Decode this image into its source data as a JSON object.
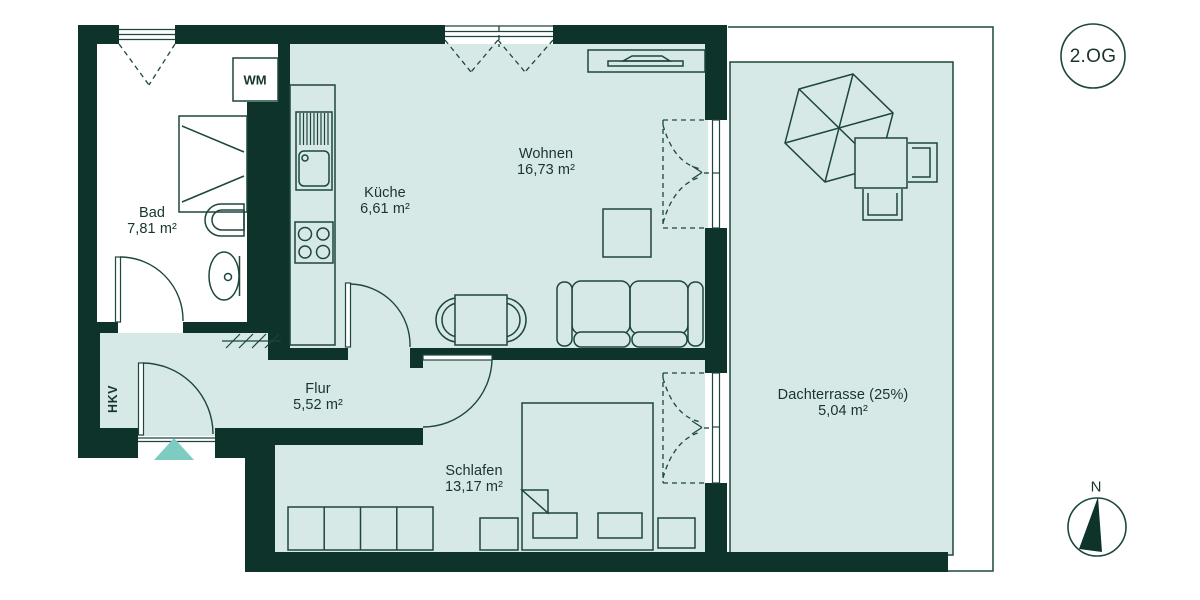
{
  "plan": {
    "floor_badge": "2.OG",
    "compass_north": "N",
    "entrance_marker": "entrance-arrow",
    "rooms": [
      {
        "id": "bad",
        "name": "Bad",
        "area": "7,81 m²"
      },
      {
        "id": "kueche",
        "name": "Küche",
        "area": "6,61 m²"
      },
      {
        "id": "wohnen",
        "name": "Wohnen",
        "area": "16,73 m²"
      },
      {
        "id": "flur",
        "name": "Flur",
        "area": "5,52 m²"
      },
      {
        "id": "schlafen",
        "name": "Schlafen",
        "area": "13,17 m²"
      },
      {
        "id": "dachterrasse",
        "name": "Dachterrasse (25%)",
        "area": "5,04 m²"
      }
    ],
    "labels": {
      "washing_machine": "WM",
      "utility_shaft": "HKV"
    },
    "furniture_icons": [
      "bathtub-icon",
      "toilet-icon",
      "washbasin-icon",
      "washing-machine-icon",
      "kitchen-counter-icon",
      "sink-icon",
      "stove-icon",
      "sideboard-tv-icon",
      "dining-table-chairs-icon",
      "side-table-icon",
      "sofa-icon",
      "wardrobe-icon",
      "double-bed-icon",
      "nightstand-icon",
      "parasol-icon",
      "terrace-table-chairs-icon",
      "shaft-hatch-icon",
      "compass-icon"
    ]
  },
  "colors": {
    "wall": "#0d332b",
    "floor": "#d7e9e6",
    "line": "#1d463d",
    "ink": "#17352d",
    "accent": "#7ecbc2",
    "paper": "#ffffff"
  }
}
